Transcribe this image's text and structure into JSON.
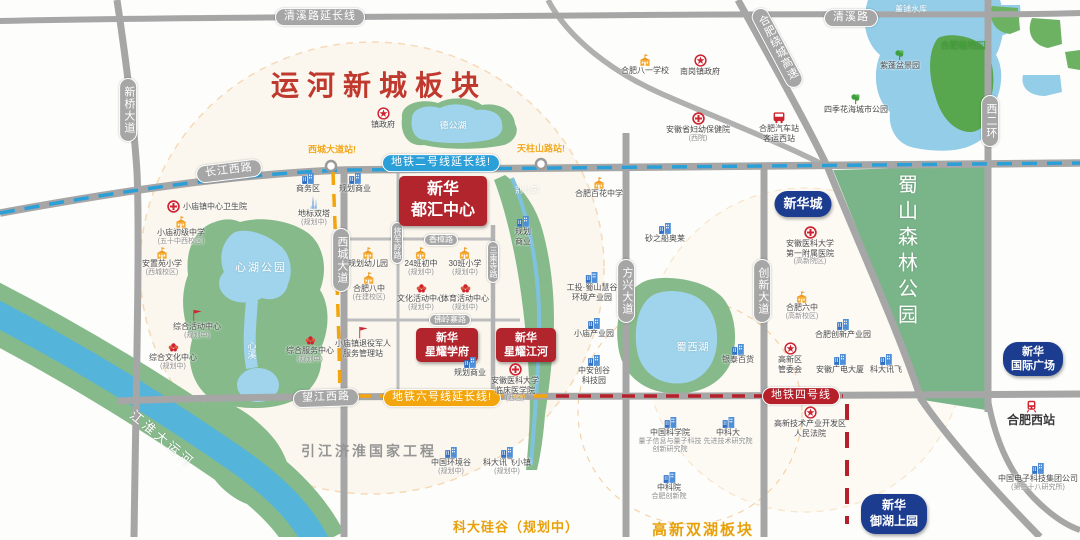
{
  "meta": {
    "title": "运河新城板块",
    "subtitle_left": "科大硅谷（规划中）",
    "subtitle_right": "高新双湖板块"
  },
  "colors": {
    "red_project_box": "#b2252d",
    "navy_project_box": "#1c3d8f",
    "metro_line2": "#2b9fd8",
    "metro_line6": "#f2a50c",
    "metro_line4": "#b5202a",
    "road_gray": "#a6a6a6",
    "park_green": "#86ba8b",
    "forest_green": "#7ab58a",
    "water_blue": "#93cde8",
    "canal_blue": "#55b4da",
    "title_red": "#c0392f",
    "station_yellow": "#f2a61a",
    "area_amber": "#e8a10a"
  },
  "area_labels": [
    {
      "text": "运河新城板块",
      "x": 379,
      "y": 84,
      "cls": "title"
    },
    {
      "text": "引江济淮国家工程",
      "x": 369,
      "y": 451,
      "cls": "gray"
    },
    {
      "text": "科大硅谷（规划中）",
      "x": 516,
      "y": 526,
      "cls": "amber"
    },
    {
      "text": "高新双湖板块",
      "x": 703,
      "y": 529,
      "cls": "amberlg"
    }
  ],
  "water_labels": [
    {
      "text": "董铺水库",
      "x": 911,
      "y": 9,
      "fs": 8
    },
    {
      "text": "德公湖",
      "x": 453,
      "y": 125,
      "fs": 9
    },
    {
      "text": "心湖公园",
      "x": 261,
      "y": 267,
      "fs": 11,
      "ls": 2
    },
    {
      "text": "心溪",
      "x": 252,
      "y": 350,
      "fs": 9,
      "v": 1
    },
    {
      "text": "别公园",
      "x": 527,
      "y": 190,
      "fs": 8
    },
    {
      "text": "蜀西湖",
      "x": 693,
      "y": 346,
      "fs": 10,
      "ls": 1
    },
    {
      "text": "蜀山森林公园",
      "x": 906,
      "y": 252,
      "fs": 20,
      "v": 1,
      "ls": 6
    },
    {
      "text": "合肥植物园",
      "x": 963,
      "y": 45,
      "fs": 9,
      "color": "#3f9d35"
    },
    {
      "text": "江淮大运河",
      "x": 163,
      "y": 438,
      "fs": 13,
      "rot": 40,
      "ls": 3
    }
  ],
  "road_labels": [
    {
      "text": "清溪路延长线",
      "x": 320,
      "y": 17
    },
    {
      "text": "清溪路",
      "x": 851,
      "y": 18
    },
    {
      "text": "新桥大道",
      "x": 128,
      "y": 110,
      "v": 1
    },
    {
      "text": "长江西路",
      "x": 229,
      "y": 171,
      "rot": -7
    },
    {
      "text": "西城大道",
      "x": 341,
      "y": 260,
      "v": 1
    },
    {
      "text": "将军岭路",
      "x": 397,
      "y": 243,
      "v": 1,
      "sm": 1
    },
    {
      "text": "三乘寺路",
      "x": 493,
      "y": 262,
      "v": 1,
      "sm": 1
    },
    {
      "text": "香樟路",
      "x": 441,
      "y": 240,
      "sm": 1
    },
    {
      "text": "佛岭寨路",
      "x": 450,
      "y": 320,
      "sm": 1
    },
    {
      "text": "方兴大道",
      "x": 626,
      "y": 291,
      "v": 1
    },
    {
      "text": "创新大道",
      "x": 762,
      "y": 291,
      "v": 1
    },
    {
      "text": "西二环",
      "x": 990,
      "y": 121,
      "v": 1
    },
    {
      "text": "合肥绕城高速",
      "x": 777,
      "y": 48,
      "v": 1,
      "rot": -28
    },
    {
      "text": "望江西路",
      "x": 326,
      "y": 398,
      "rot": -2
    },
    {
      "text": "地铁二号线延长线!",
      "x": 441,
      "y": 163,
      "cls": "m2"
    },
    {
      "text": "地铁六号线延长线!",
      "x": 442,
      "y": 398,
      "cls": "m6"
    },
    {
      "text": "地铁四号线",
      "x": 801,
      "y": 396,
      "cls": "m4"
    }
  ],
  "stations": [
    {
      "text": "西城大道站!",
      "x": 332,
      "y": 149
    },
    {
      "text": "天柱山路站!",
      "x": 541,
      "y": 148
    }
  ],
  "projects": [
    {
      "l": [
        "新华",
        "都汇中心"
      ],
      "x": 443,
      "y": 201,
      "style": "red",
      "w": 88,
      "h": 50,
      "fs": 16
    },
    {
      "l": [
        "新华",
        "星耀学府"
      ],
      "x": 447,
      "y": 345,
      "style": "red",
      "w": 62,
      "h": 34,
      "fs": 11
    },
    {
      "l": [
        "新华",
        "星耀江河"
      ],
      "x": 526,
      "y": 345,
      "style": "red",
      "w": 60,
      "h": 34,
      "fs": 11
    },
    {
      "l": [
        "新华城"
      ],
      "x": 803,
      "y": 204,
      "style": "navy",
      "w": 57,
      "h": 26,
      "fs": 13
    },
    {
      "l": [
        "新华",
        "国际广场"
      ],
      "x": 1033,
      "y": 359,
      "style": "navy",
      "w": 60,
      "h": 34,
      "fs": 11
    },
    {
      "l": [
        "新华",
        "御湖上园"
      ],
      "x": 894,
      "y": 514,
      "style": "navy",
      "w": 66,
      "h": 40,
      "fs": 12
    }
  ],
  "pois": [
    {
      "t": "gov",
      "x": 383,
      "y": 107,
      "l": [
        "镇政府"
      ]
    },
    {
      "t": "school",
      "x": 645,
      "y": 54,
      "l": [
        "合肥八一学校"
      ]
    },
    {
      "t": "gov",
      "x": 700,
      "y": 54,
      "l": [
        "南岗镇政府"
      ]
    },
    {
      "t": "tree",
      "x": 900,
      "y": 49,
      "l": [
        "紫蓬盆景园"
      ]
    },
    {
      "t": "tree",
      "x": 856,
      "y": 93,
      "l": [
        "四季花海城市公园"
      ]
    },
    {
      "t": "hospital",
      "x": 698,
      "y": 112,
      "l": [
        "安徽省妇幼保健院"
      ],
      "s": [
        "(西院)"
      ]
    },
    {
      "t": "bus",
      "x": 779,
      "y": 111,
      "l": [
        "合肥汽车站",
        "客运西站"
      ]
    },
    {
      "t": "hospital",
      "x": 207,
      "y": 200,
      "l": [
        "小庙镇中心卫生院"
      ],
      "side": 1
    },
    {
      "t": "school",
      "x": 181,
      "y": 216,
      "l": [
        "小庙初级中学"
      ],
      "s": [
        "(五十中西校区)"
      ]
    },
    {
      "t": "school",
      "x": 162,
      "y": 247,
      "l": [
        "安置苑小学"
      ],
      "s": [
        "(西城校区)"
      ]
    },
    {
      "t": "flag",
      "x": 197,
      "y": 309,
      "l": [
        "综合活动中心"
      ],
      "s": [
        "(规划中)"
      ]
    },
    {
      "t": "flower",
      "x": 173,
      "y": 341,
      "l": [
        "综合文化中心"
      ],
      "s": [
        "(规划中)"
      ]
    },
    {
      "t": "flower",
      "x": 310,
      "y": 334,
      "l": [
        "综合服务中心"
      ],
      "s": [
        "(规划中)"
      ]
    },
    {
      "t": "flag",
      "x": 363,
      "y": 326,
      "l": [
        "小庙镇退役军人",
        "服务管理站"
      ]
    },
    {
      "t": "building",
      "x": 308,
      "y": 172,
      "l": [
        "商务区"
      ]
    },
    {
      "t": "building",
      "x": 355,
      "y": 172,
      "l": [
        "规划商业"
      ]
    },
    {
      "t": "towers",
      "x": 314,
      "y": 195,
      "l": [
        "地标双塔"
      ],
      "s": [
        "(规划中)"
      ]
    },
    {
      "t": "school",
      "x": 368,
      "y": 247,
      "l": [
        "规划幼儿园"
      ]
    },
    {
      "t": "school",
      "x": 421,
      "y": 247,
      "l": [
        "24班初中"
      ],
      "s": [
        "(规划中)"
      ]
    },
    {
      "t": "school",
      "x": 465,
      "y": 247,
      "l": [
        "30班小学"
      ],
      "s": [
        "(规划中)"
      ]
    },
    {
      "t": "school",
      "x": 369,
      "y": 272,
      "l": [
        "合肥八中"
      ],
      "s": [
        "(在建校区)"
      ]
    },
    {
      "t": "flower",
      "x": 421,
      "y": 282,
      "l": [
        "文化活动中心"
      ],
      "s": [
        "(规划中)"
      ]
    },
    {
      "t": "flower",
      "x": 465,
      "y": 282,
      "l": [
        "体育活动中心"
      ],
      "s": [
        "(规划中)"
      ]
    },
    {
      "t": "building",
      "x": 523,
      "y": 215,
      "l": [
        "规划",
        "商业"
      ]
    },
    {
      "t": "building",
      "x": 470,
      "y": 356,
      "l": [
        "规划商业"
      ]
    },
    {
      "t": "hospital",
      "x": 515,
      "y": 363,
      "l": [
        "安徽医科大学",
        "临床医学院"
      ],
      "s": [
        "(西区)"
      ]
    },
    {
      "t": "school",
      "x": 599,
      "y": 177,
      "l": [
        "合肥百花中学"
      ]
    },
    {
      "t": "building",
      "x": 665,
      "y": 222,
      "l": [
        "砂之船奥莱"
      ]
    },
    {
      "t": "building",
      "x": 592,
      "y": 271,
      "l": [
        "工投·蜀山慧谷",
        "环境产业园"
      ]
    },
    {
      "t": "building",
      "x": 594,
      "y": 317,
      "l": [
        "小庙产业园"
      ]
    },
    {
      "t": "building",
      "x": 594,
      "y": 354,
      "l": [
        "中安创谷",
        "科技园"
      ]
    },
    {
      "t": "building",
      "x": 738,
      "y": 343,
      "l": [
        "银泰百货"
      ]
    },
    {
      "t": "gov",
      "x": 790,
      "y": 342,
      "l": [
        "高新区",
        "管委会"
      ]
    },
    {
      "t": "building",
      "x": 843,
      "y": 318,
      "l": [
        "合肥创新产业园"
      ]
    },
    {
      "t": "school",
      "x": 802,
      "y": 291,
      "l": [
        "合肥六中"
      ],
      "s": [
        "(高新校区)"
      ]
    },
    {
      "t": "hospital",
      "x": 810,
      "y": 226,
      "l": [
        "安徽医科大学",
        "第一附属医院"
      ],
      "s": [
        "(高新院区)"
      ]
    },
    {
      "t": "building",
      "x": 840,
      "y": 353,
      "l": [
        "安徽广电大厦"
      ]
    },
    {
      "t": "building",
      "x": 886,
      "y": 353,
      "l": [
        "科大讯飞"
      ]
    },
    {
      "t": "building",
      "x": 451,
      "y": 446,
      "l": [
        "中国环境谷"
      ],
      "s": [
        "(规划中)"
      ]
    },
    {
      "t": "building",
      "x": 507,
      "y": 446,
      "l": [
        "科大讯飞小镇"
      ],
      "s": [
        "(规划中)"
      ]
    },
    {
      "t": "building",
      "x": 670,
      "y": 416,
      "l": [
        "中国科学院"
      ],
      "s": [
        "量子信息与量子科技",
        "创新研究院"
      ]
    },
    {
      "t": "building",
      "x": 728,
      "y": 416,
      "l": [
        "中科大"
      ],
      "s": [
        "先进技术研究院"
      ]
    },
    {
      "t": "building",
      "x": 669,
      "y": 471,
      "l": [
        "中科院"
      ],
      "s": [
        "合肥创新院"
      ]
    },
    {
      "t": "gov",
      "x": 810,
      "y": 406,
      "l": [
        "高新技术产业开发区",
        "人民法院"
      ]
    },
    {
      "t": "train",
      "x": 1031,
      "y": 400,
      "l": [
        "合肥西站"
      ],
      "big": 1
    },
    {
      "t": "building",
      "x": 1038,
      "y": 462,
      "l": [
        "中国电子科技集团公司"
      ],
      "s": [
        "(第三十八研究所)"
      ]
    }
  ]
}
